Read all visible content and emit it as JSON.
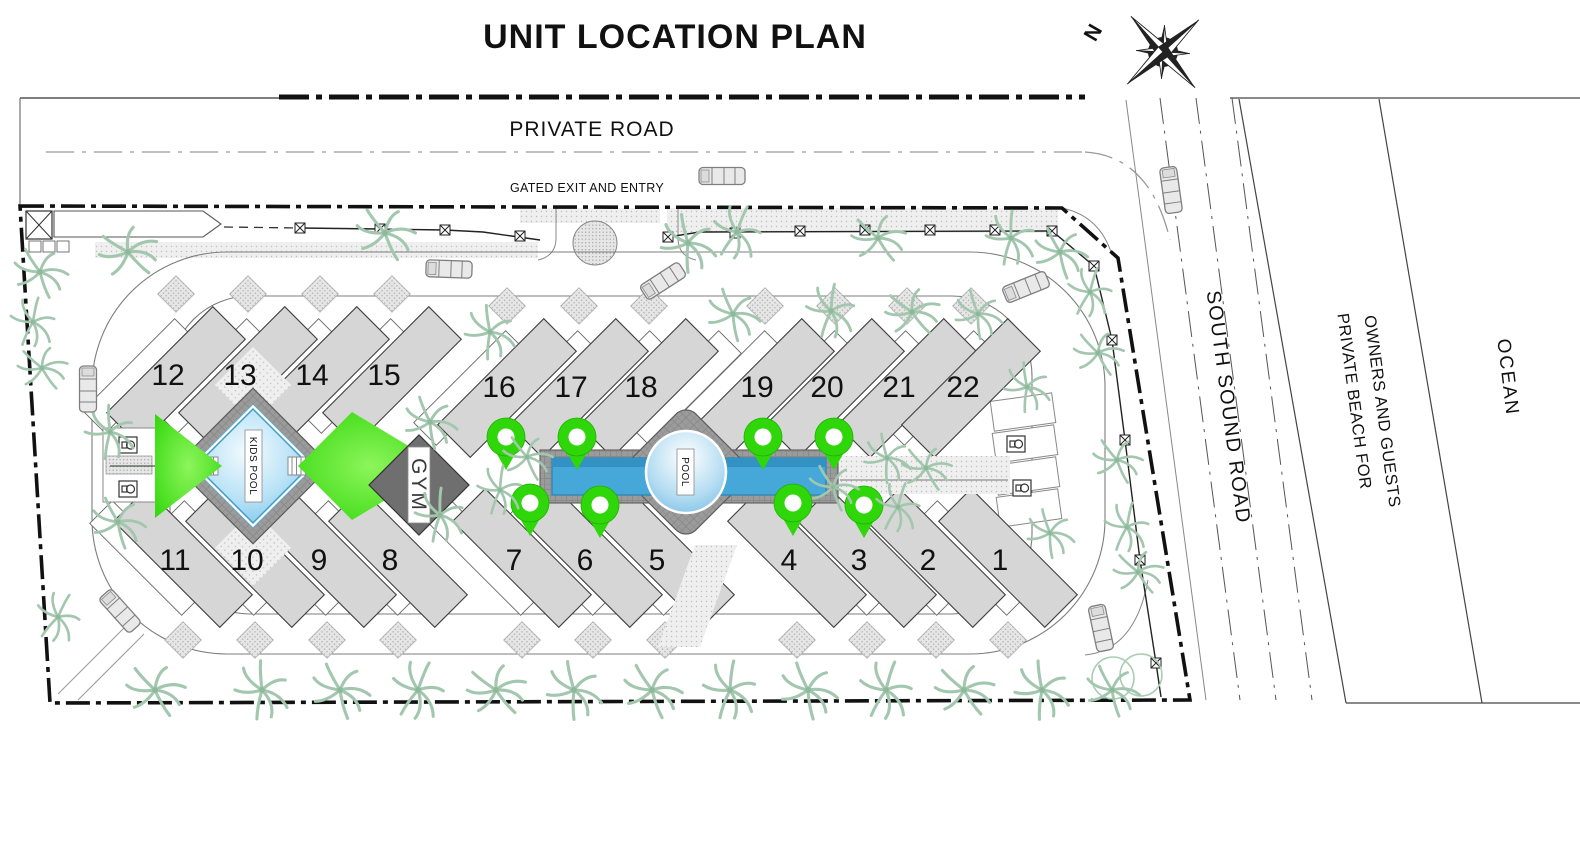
{
  "title": "UNIT LOCATION PLAN",
  "compass": {
    "north": "N"
  },
  "roads": {
    "private_road": "PRIVATE ROAD",
    "gate_label": "GATED EXIT AND ENTRY",
    "south_sound_road": "SOUTH SOUND ROAD"
  },
  "parcels": {
    "beach_line1": "PRIVATE BEACH FOR",
    "beach_line2": "OWNERS AND GUESTS",
    "ocean": "OCEAN"
  },
  "amenities": {
    "kids_pool": "KIDS POOL",
    "gym": "GYM",
    "pool": "POOL"
  },
  "units": [
    "12",
    "13",
    "14",
    "15",
    "16",
    "17",
    "18",
    "19",
    "20",
    "21",
    "22",
    "11",
    "10",
    "9",
    "8",
    "7",
    "6",
    "5",
    "4",
    "3",
    "2",
    "1"
  ],
  "colors": {
    "accent_green": "#2fd60a",
    "pool_blue": "#45a8d8",
    "deck_gray": "#9b9b9b",
    "building_gray": "#d6d6d6",
    "gym_gray": "#6f6f6f",
    "palm_green": "#a3c7ae",
    "line_black": "#111111"
  }
}
